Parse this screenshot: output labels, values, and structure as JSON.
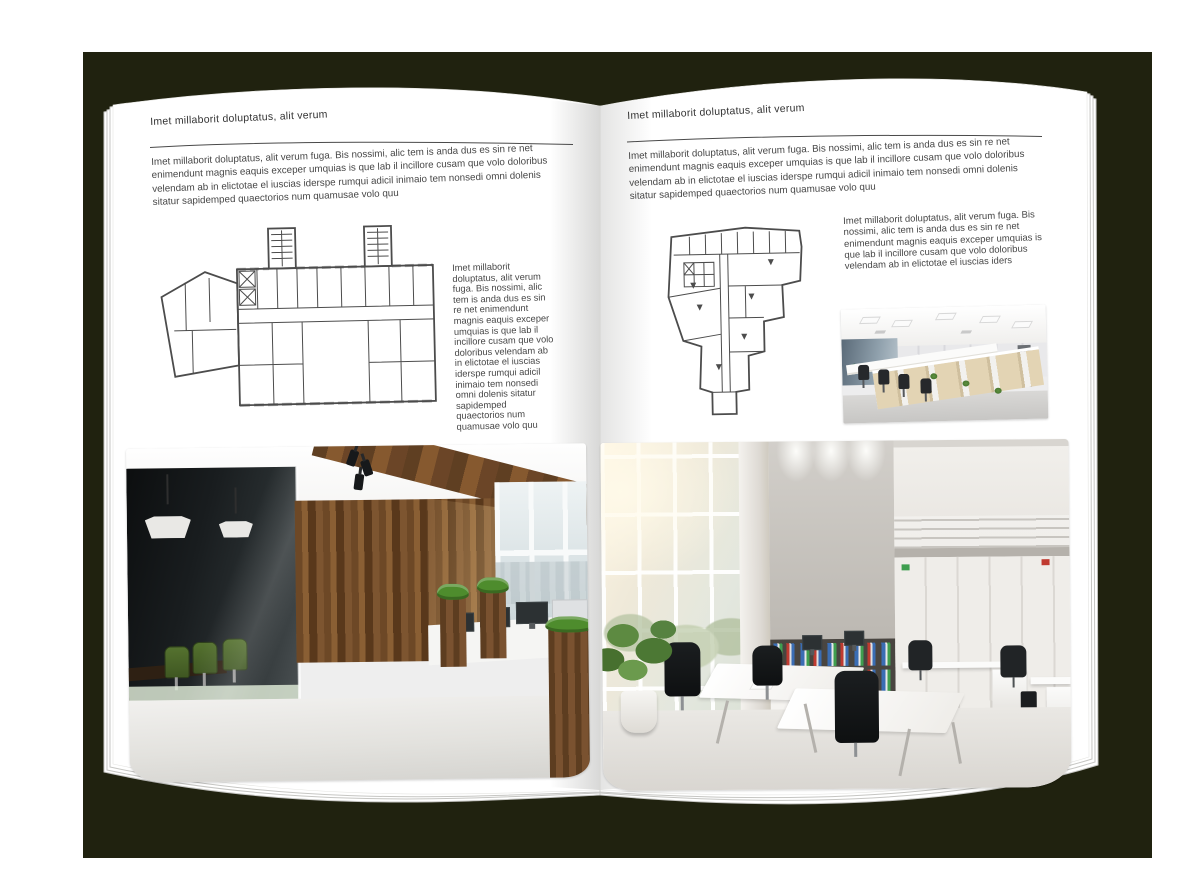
{
  "palette": {
    "backdrop": "#20220f",
    "page": "#ffffff",
    "ink": "#3c3c3c",
    "rule": "#4a4a4a",
    "plan": "#4c4c4c",
    "wood": "#7b5430",
    "chair_green": "#4f6a31",
    "grass": "#4e8c2d",
    "binder_blue": "#3a6db4",
    "binder_green": "#3f9e4f",
    "binder_red": "#c03a30",
    "concrete": "#bcb8b2"
  },
  "left_page": {
    "header": "Imet millaborit doluptatus, alit verum",
    "intro": "Imet millaborit doluptatus, alit verum fuga. Bis nossimi, alic tem is anda dus es sin re net enimendunt magnis eaquis exceper umquias is que lab il incillore cusam que volo doloribus velendam ab in elictotae el iuscias iderspe rumqui adicil inimaio tem nonsedi omni dolenis sitatur sapidemped quaectorios num quamusae volo quu",
    "side_text": "Imet millaborit doluptatus, alit verum fuga. Bis nossimi, alic tem is anda dus es sin re net enimendunt magnis eaquis exceper umquias is que lab il incillore cusam que volo doloribus velendam ab in elictotae el iuscias iderspe rumqui adicil inimaio tem nonsedi omni dolenis sitatur sapidemped quaectorios num quamusae volo quu"
  },
  "right_page": {
    "header": "Imet millaborit doluptatus, alit verum",
    "intro": "Imet millaborit doluptatus, alit verum fuga. Bis nossimi, alic tem is anda dus es sin re net enimendunt magnis eaquis exceper umquias is que lab il incillore cusam que volo doloribus velendam ab in elictotae el iuscias iderspe rumqui adicil inimaio tem nonsedi omni dolenis sitatur sapidemped quaectorios num quamusae volo quu",
    "side_text": "Imet millaborit doluptatus, alit verum fuga. Bis nossimi, alic tem is anda dus es sin re net enimendunt magnis eaquis exceper umquias is que lab il incillore cusam que volo doloribus velendam ab in elictotae el iuscias iders"
  }
}
